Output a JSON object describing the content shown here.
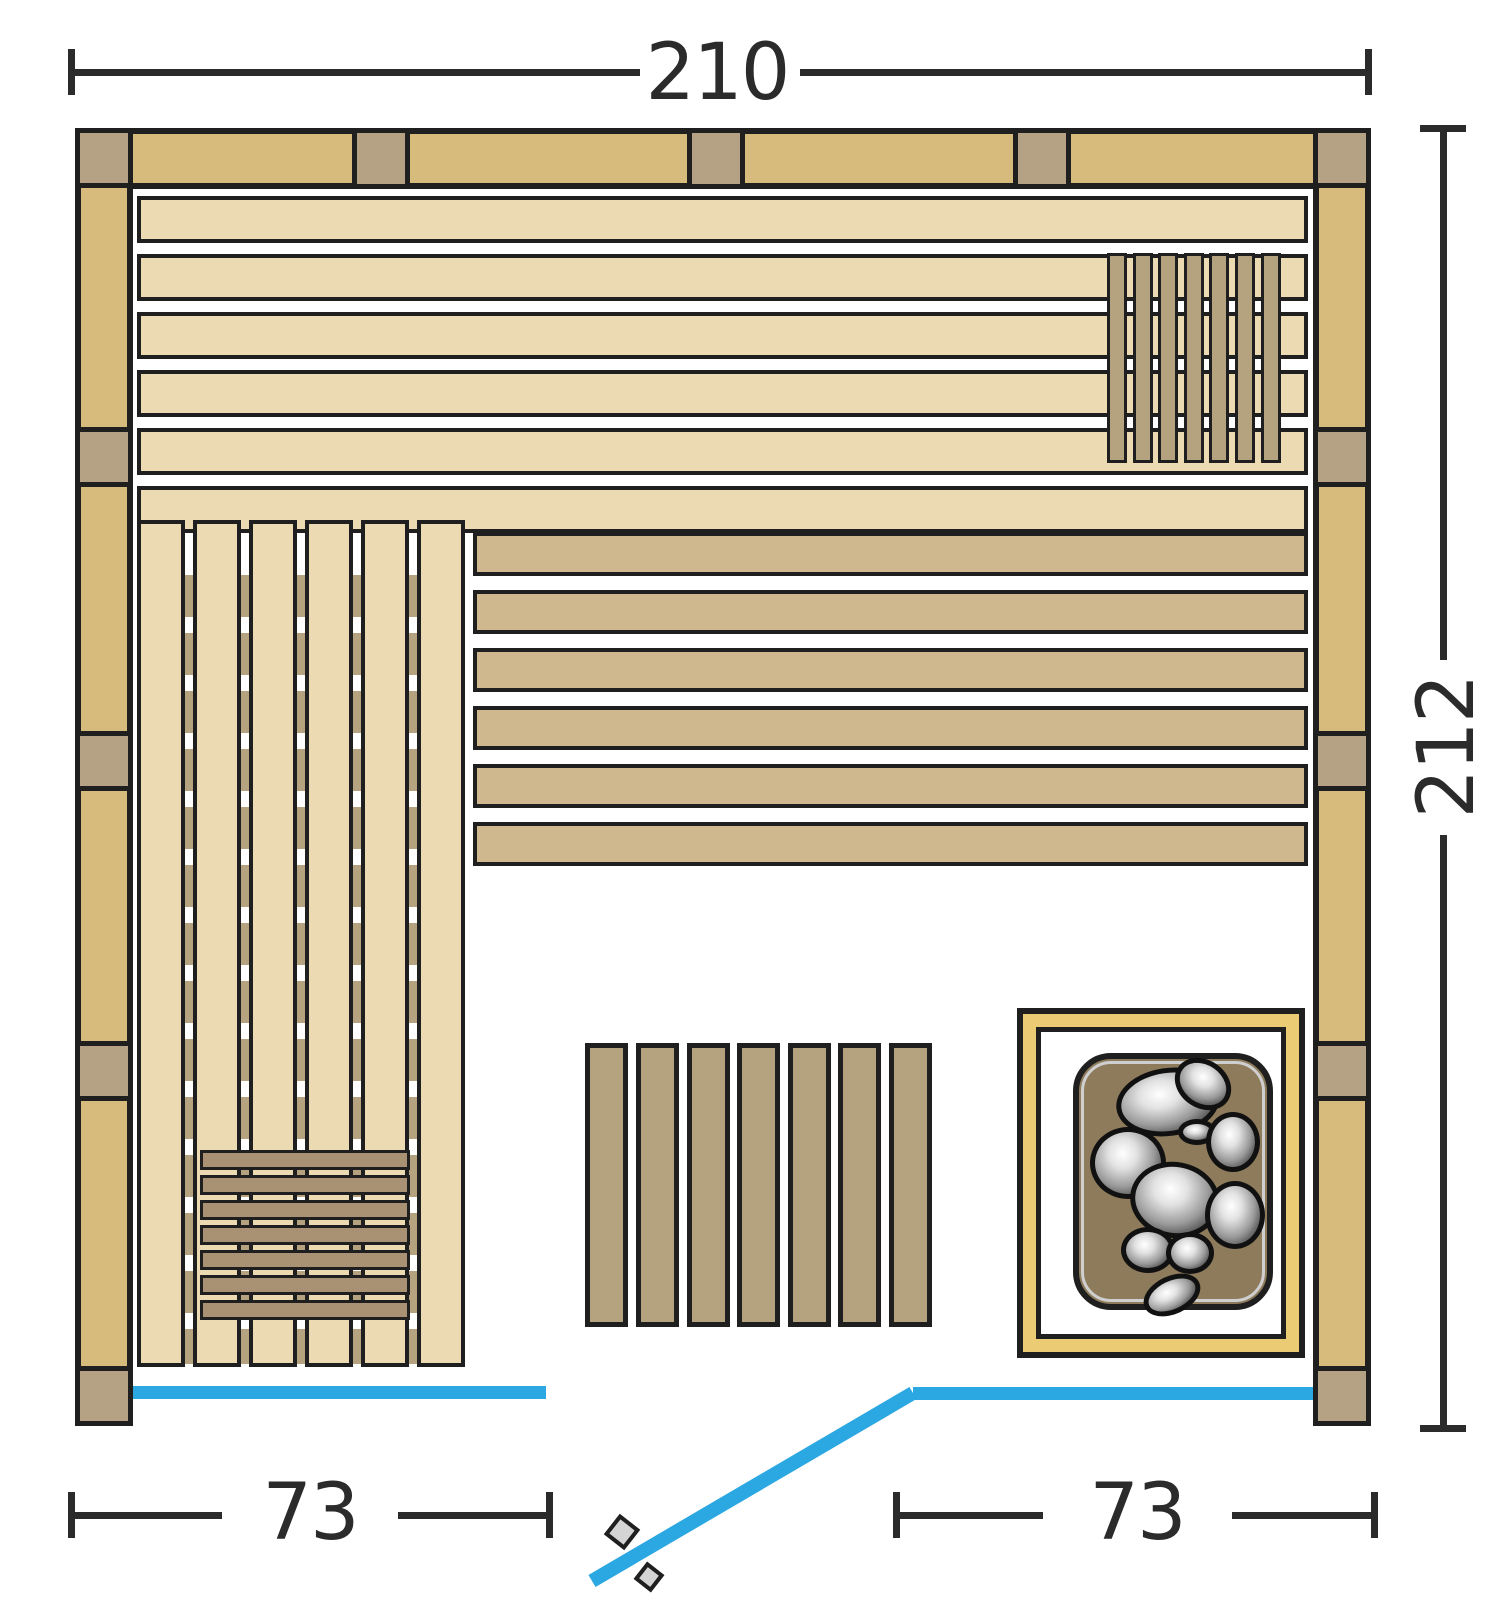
{
  "title": "Sauna floor plan (top view)",
  "dimensions": {
    "top": {
      "label": "210"
    },
    "right": {
      "label": "212"
    },
    "bottom_left": {
      "label": "73"
    },
    "bottom_right": {
      "label": "73"
    }
  },
  "colors": {
    "bg": "#ffffff",
    "outline": "#1f1f1f",
    "dim": "#2b2b2b",
    "wall_wood": "#d6bb7d",
    "stud": "#b5a183",
    "plank_light": "#ecdbb2",
    "bench_dark": "#cfb88e",
    "slat_mid": "#b5a27e",
    "step_brown": "#a99273",
    "heater_gold": "#ebcb74",
    "heater_body": "#8d7b5b",
    "heater_ring": "#cfcfcf",
    "glass_blue": "#2ba7e2",
    "handle_gray": "#d4d4d4"
  },
  "layout": {
    "canvas": {
      "w": 1504,
      "h": 1600
    },
    "walls": {
      "top": {
        "x": 75,
        "y": 128,
        "w": 1296,
        "h": 61
      },
      "left": {
        "x": 75,
        "y": 128,
        "w": 58,
        "h": 1298
      },
      "right": {
        "x": 1313,
        "y": 128,
        "w": 58,
        "h": 1298
      },
      "top_studs_x": [
        352,
        687,
        1013
      ],
      "top_stud_w": 58,
      "side_studs_y": [
        128,
        427,
        731,
        1041,
        1366
      ],
      "side_stud_h": 60
    },
    "upper_planks": {
      "x": 137,
      "w": 1171,
      "ys": [
        196,
        254,
        312,
        370,
        428,
        486
      ],
      "h": 47
    },
    "backrest": {
      "y": 253,
      "h": 210,
      "xs": [
        1107,
        1133,
        1158,
        1184,
        1209,
        1235,
        1261
      ],
      "w": 20
    },
    "left_bench": {
      "y": 520,
      "h": 847,
      "xs": [
        137,
        193,
        249,
        305,
        361,
        417
      ],
      "w": 48,
      "rail_xs": [
        185,
        241,
        297,
        353,
        409
      ],
      "rail_w": 8,
      "rail_y": 575,
      "rail_h": 789
    },
    "dark_bench": {
      "x": 473,
      "w": 835,
      "ys": [
        532,
        590,
        648,
        706,
        764,
        822
      ],
      "h": 44
    },
    "floor_mat": {
      "y": 1043,
      "h": 284,
      "xs": [
        585,
        636,
        687,
        737,
        788,
        838,
        889
      ],
      "w": 43
    },
    "step": {
      "x": 200,
      "w": 210,
      "ys": [
        1150,
        1175,
        1200,
        1225,
        1250,
        1275,
        1300
      ],
      "h": 20
    },
    "heater": {
      "outer": {
        "x": 1017,
        "y": 1008,
        "w": 288,
        "h": 350
      },
      "inner": {
        "x": 1036,
        "y": 1027,
        "w": 250,
        "h": 312
      },
      "body": {
        "x": 1073,
        "y": 1053,
        "w": 200,
        "h": 257,
        "r": 38
      },
      "ring": {
        "x": 1081,
        "y": 1061,
        "w": 184,
        "h": 241,
        "r": 30
      },
      "stones": [
        [
          1168,
          1102,
          52,
          34,
          -8
        ],
        [
          1203,
          1084,
          30,
          24,
          35
        ],
        [
          1128,
          1163,
          38,
          36,
          0
        ],
        [
          1197,
          1132,
          19,
          13,
          0
        ],
        [
          1233,
          1142,
          27,
          30,
          0
        ],
        [
          1175,
          1200,
          45,
          38,
          10
        ],
        [
          1235,
          1215,
          30,
          34,
          0
        ],
        [
          1148,
          1250,
          27,
          23,
          0
        ],
        [
          1190,
          1253,
          24,
          21,
          0
        ],
        [
          1172,
          1295,
          30,
          19,
          -25
        ]
      ]
    },
    "glass": {
      "left": {
        "x": 133,
        "y": 1386,
        "w": 413,
        "h": 13
      },
      "right": {
        "x": 913,
        "y": 1387,
        "w": 400,
        "h": 13
      },
      "door": {
        "x1": 913,
        "y1": 1393,
        "x2": 592,
        "y2": 1581,
        "w": 14
      },
      "handles": [
        {
          "cx": 622,
          "cy": 1532,
          "s": 26,
          "rot": 38
        },
        {
          "cx": 649,
          "cy": 1577,
          "s": 22,
          "rot": 38
        }
      ]
    },
    "dims": {
      "top": {
        "y": 69,
        "x1": 71,
        "x2": 1368,
        "gap1": 640,
        "gap2": 800,
        "tick_y": 49,
        "label_cx": 717,
        "label_cy": 73
      },
      "right": {
        "x": 1440,
        "y1": 128,
        "y2": 1428,
        "gap1": 660,
        "gap2": 835,
        "tick_x": 1420,
        "label_cx": 1447,
        "label_cy": 747
      },
      "bottom_left": {
        "y": 1512,
        "x1": 71,
        "x2": 549,
        "gap1": 222,
        "gap2": 398,
        "tick_y": 1492,
        "label_cx": 310,
        "label_cy": 1513
      },
      "bottom_right": {
        "y": 1512,
        "x1": 896,
        "x2": 1374,
        "gap1": 1043,
        "gap2": 1232,
        "tick_y": 1492,
        "label_cx": 1137,
        "label_cy": 1513
      }
    }
  }
}
